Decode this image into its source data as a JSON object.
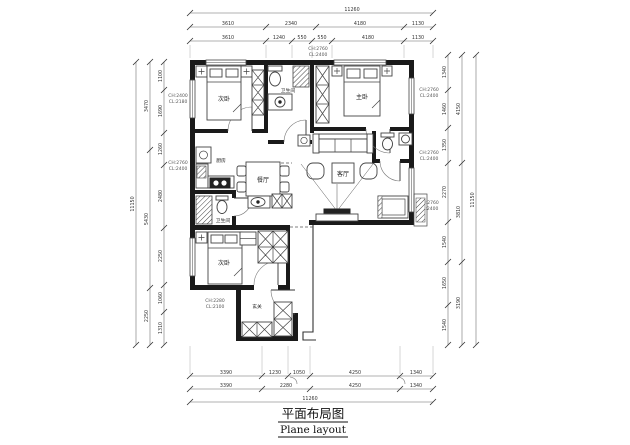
{
  "title": {
    "cn": "平面布局图",
    "en": "Plane layout"
  },
  "rooms": {
    "bedroom1": "次卧",
    "master": "主卧",
    "bedroom2": "次卧",
    "living": "客厅",
    "dining": "餐厅",
    "kitchen": "厨房",
    "bath1": "卫生间",
    "bath2": "卫生间",
    "foyer": "玄关"
  },
  "annotations": {
    "top_center": [
      "CH:2760",
      "CL:2400"
    ],
    "left_upper": [
      "CH:2400",
      "CL:2180"
    ],
    "left_lower": [
      "CH:2760",
      "CL:2400"
    ],
    "right_upper": [
      "CH:2760",
      "CL:2400"
    ],
    "right_mid": [
      "CH:2760",
      "CL:2400"
    ],
    "right_lower": [
      "CH:2760",
      "CL:2400"
    ],
    "foyer_note": [
      "CH:2280",
      "CL:2100"
    ]
  },
  "dims": {
    "top_row1": "11260",
    "top_row2": [
      "3610",
      "2340",
      "4180",
      "1130"
    ],
    "top_row3": [
      "3610",
      "1240",
      "550",
      "550",
      "4180",
      "1130"
    ],
    "bottom_row1": [
      "3390",
      "1230",
      "1050",
      "4250",
      "1340"
    ],
    "bottom_row2": [
      "3390",
      "2280",
      "4250",
      "1340"
    ],
    "bottom_row3": "11260",
    "left_outer": "11150",
    "left_mid": [
      "3470",
      "5430",
      "2250"
    ],
    "left_inner": [
      "1100",
      "1690",
      "1260",
      "2480",
      "2250",
      "1060",
      "1310"
    ],
    "right_outer": "11150",
    "right_mid": [
      "4150",
      "3810",
      "3190"
    ],
    "right_inner": [
      "1340",
      "1460",
      "1350",
      "2270",
      "1540",
      "1650",
      "1540"
    ]
  }
}
